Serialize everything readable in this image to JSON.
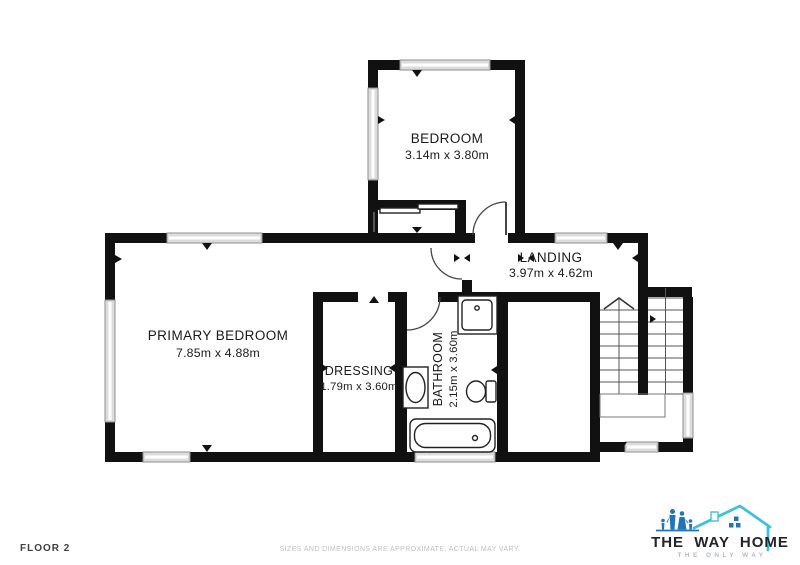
{
  "floor_label": "FLOOR 2",
  "disclaimer": "SIZES AND DIMENSIONS ARE APPROXIMATE, ACTUAL MAY VARY.",
  "rooms": [
    {
      "name": "BEDROOM",
      "dims": "3.14m x 3.80m"
    },
    {
      "name": "LANDING",
      "dims": "3.97m x 4.62m"
    },
    {
      "name": "PRIMARY BEDROOM",
      "dims": "7.85m x 4.88m"
    },
    {
      "name": "DRESSING",
      "dims": "1.79m x 3.60m"
    },
    {
      "name": "BATHROOM",
      "dims": "2.15m x 3.60m"
    }
  ],
  "fixtures": [
    "shower",
    "sink",
    "toilet",
    "bathtub",
    "staircase",
    "wardrobe"
  ],
  "logo": {
    "brand": "THE WAY HOME",
    "tagline": "THE ONLY WAY"
  },
  "colors": {
    "wall": "#111111",
    "window_fill": "#dcdcdc",
    "label_text": "#1a1a1a",
    "floor_label_text": "#3e3e3e",
    "disclaimer_text": "#c0c0c0",
    "logo_family_blue": "#2273b8",
    "logo_roof_cyan": "#3fc0dc",
    "logo_brand_dark": "#23242c",
    "logo_tagline_gray": "#b5bac3"
  }
}
